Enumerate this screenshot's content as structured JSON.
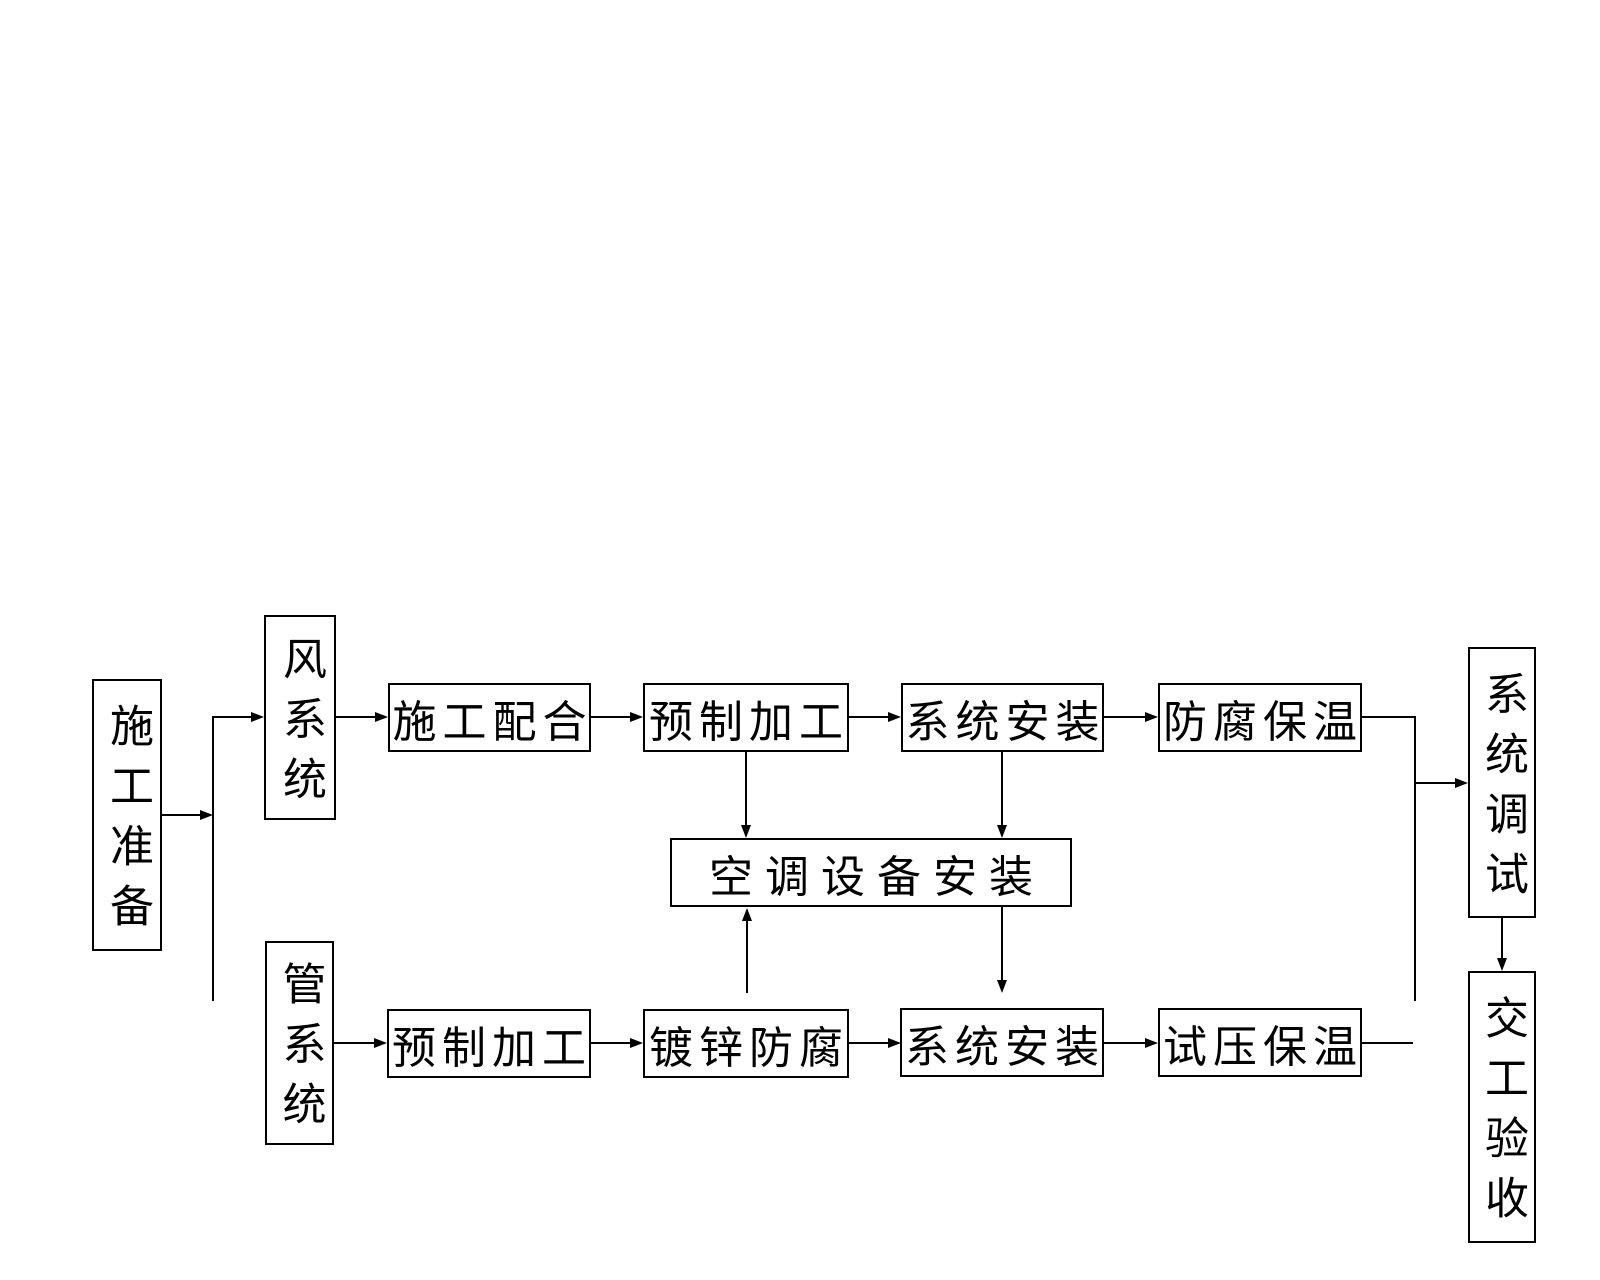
{
  "diagram": {
    "type": "flowchart",
    "colors": {
      "background": "#ffffff",
      "line": "#000000",
      "text": "#000000"
    },
    "nodes": {
      "prep": {
        "label": "施工准备",
        "orientation": "vertical"
      },
      "air_system": {
        "label": "风系统",
        "orientation": "vertical"
      },
      "pipe_system": {
        "label": "管系统",
        "orientation": "vertical"
      },
      "construction_coordination": {
        "label": "施工配合",
        "orientation": "horizontal"
      },
      "prefab_air": {
        "label": "预制加工",
        "orientation": "horizontal"
      },
      "system_install_air": {
        "label": "系统安装",
        "orientation": "horizontal"
      },
      "anticorrosion_insulation": {
        "label": "防腐保温",
        "orientation": "horizontal"
      },
      "ac_equipment_install": {
        "label": "空调设备安装",
        "orientation": "horizontal"
      },
      "prefab_pipe": {
        "label": "预制加工",
        "orientation": "horizontal"
      },
      "galvanize_anticorrosion": {
        "label": "镀锌防腐",
        "orientation": "horizontal"
      },
      "system_install_pipe": {
        "label": "系统安装",
        "orientation": "horizontal"
      },
      "pressure_test_insulation": {
        "label": "试压保温",
        "orientation": "horizontal"
      },
      "system_commissioning": {
        "label": "系统调试",
        "orientation": "vertical"
      },
      "handover_acceptance": {
        "label": "交工验收",
        "orientation": "vertical"
      }
    },
    "edges": [
      {
        "from": "prep",
        "to": "air_system"
      },
      {
        "from": "prep",
        "to": "pipe_system"
      },
      {
        "from": "air_system",
        "to": "construction_coordination"
      },
      {
        "from": "construction_coordination",
        "to": "prefab_air"
      },
      {
        "from": "prefab_air",
        "to": "system_install_air"
      },
      {
        "from": "system_install_air",
        "to": "anticorrosion_insulation"
      },
      {
        "from": "anticorrosion_insulation",
        "to": "system_commissioning"
      },
      {
        "from": "prefab_air",
        "to": "ac_equipment_install"
      },
      {
        "from": "system_install_air",
        "to": "ac_equipment_install"
      },
      {
        "from": "pipe_system",
        "to": "prefab_pipe"
      },
      {
        "from": "prefab_pipe",
        "to": "galvanize_anticorrosion"
      },
      {
        "from": "galvanize_anticorrosion",
        "to": "system_install_pipe"
      },
      {
        "from": "galvanize_anticorrosion",
        "to": "ac_equipment_install"
      },
      {
        "from": "ac_equipment_install",
        "to": "system_install_pipe"
      },
      {
        "from": "system_install_pipe",
        "to": "pressure_test_insulation"
      },
      {
        "from": "pressure_test_insulation",
        "to": "system_commissioning"
      },
      {
        "from": "system_commissioning",
        "to": "handover_acceptance"
      }
    ]
  }
}
